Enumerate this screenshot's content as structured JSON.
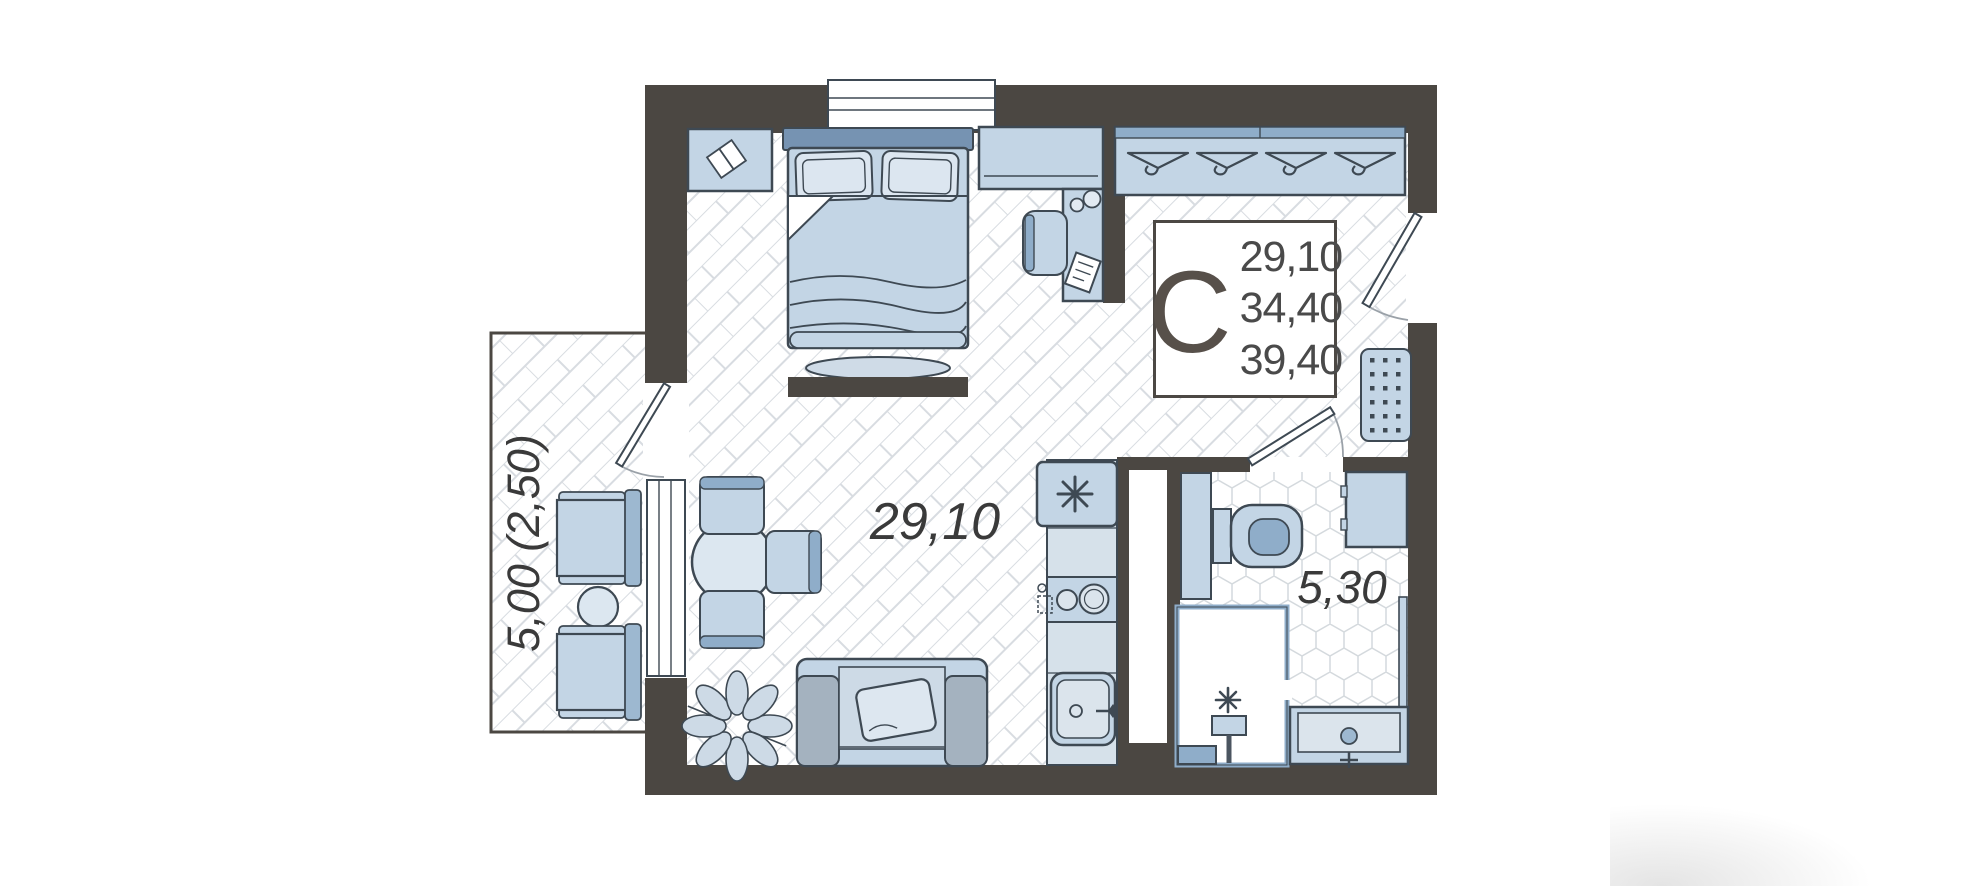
{
  "plan": {
    "unit_label": {
      "letter": "С",
      "area_living": "29,10",
      "area_apartment": "34,40",
      "area_total": "39,40"
    },
    "rooms": {
      "main_room_area": "29,10",
      "bathroom_area": "5,30",
      "balcony_area": "5,00 (2,50)"
    },
    "colors": {
      "wall": "#4b4742",
      "furniture_fill": "#c3d5e5",
      "furniture_light": "#dbe4ec",
      "furniture_accent": "#8fadc9",
      "outline": "#3e4953",
      "floor_line": "#d8dce1",
      "label_text": "#3a3a3a"
    },
    "furniture_icons": [
      "double-bed",
      "pillows",
      "nightstand",
      "open-book",
      "tv-console",
      "desk",
      "desk-chair",
      "wardrobe-hangers",
      "radiator",
      "entrance-door",
      "balcony-door",
      "window",
      "fridge-snowflake",
      "hob-burners",
      "kitchen-sink",
      "tall-cabinet",
      "toilet",
      "washing-machine",
      "shower",
      "shower-head",
      "vanity-sink",
      "towel-rail",
      "dining-table",
      "dining-chair",
      "sofa",
      "sofa-pillow",
      "potted-plant",
      "balcony-armchair",
      "balcony-side-table"
    ]
  }
}
